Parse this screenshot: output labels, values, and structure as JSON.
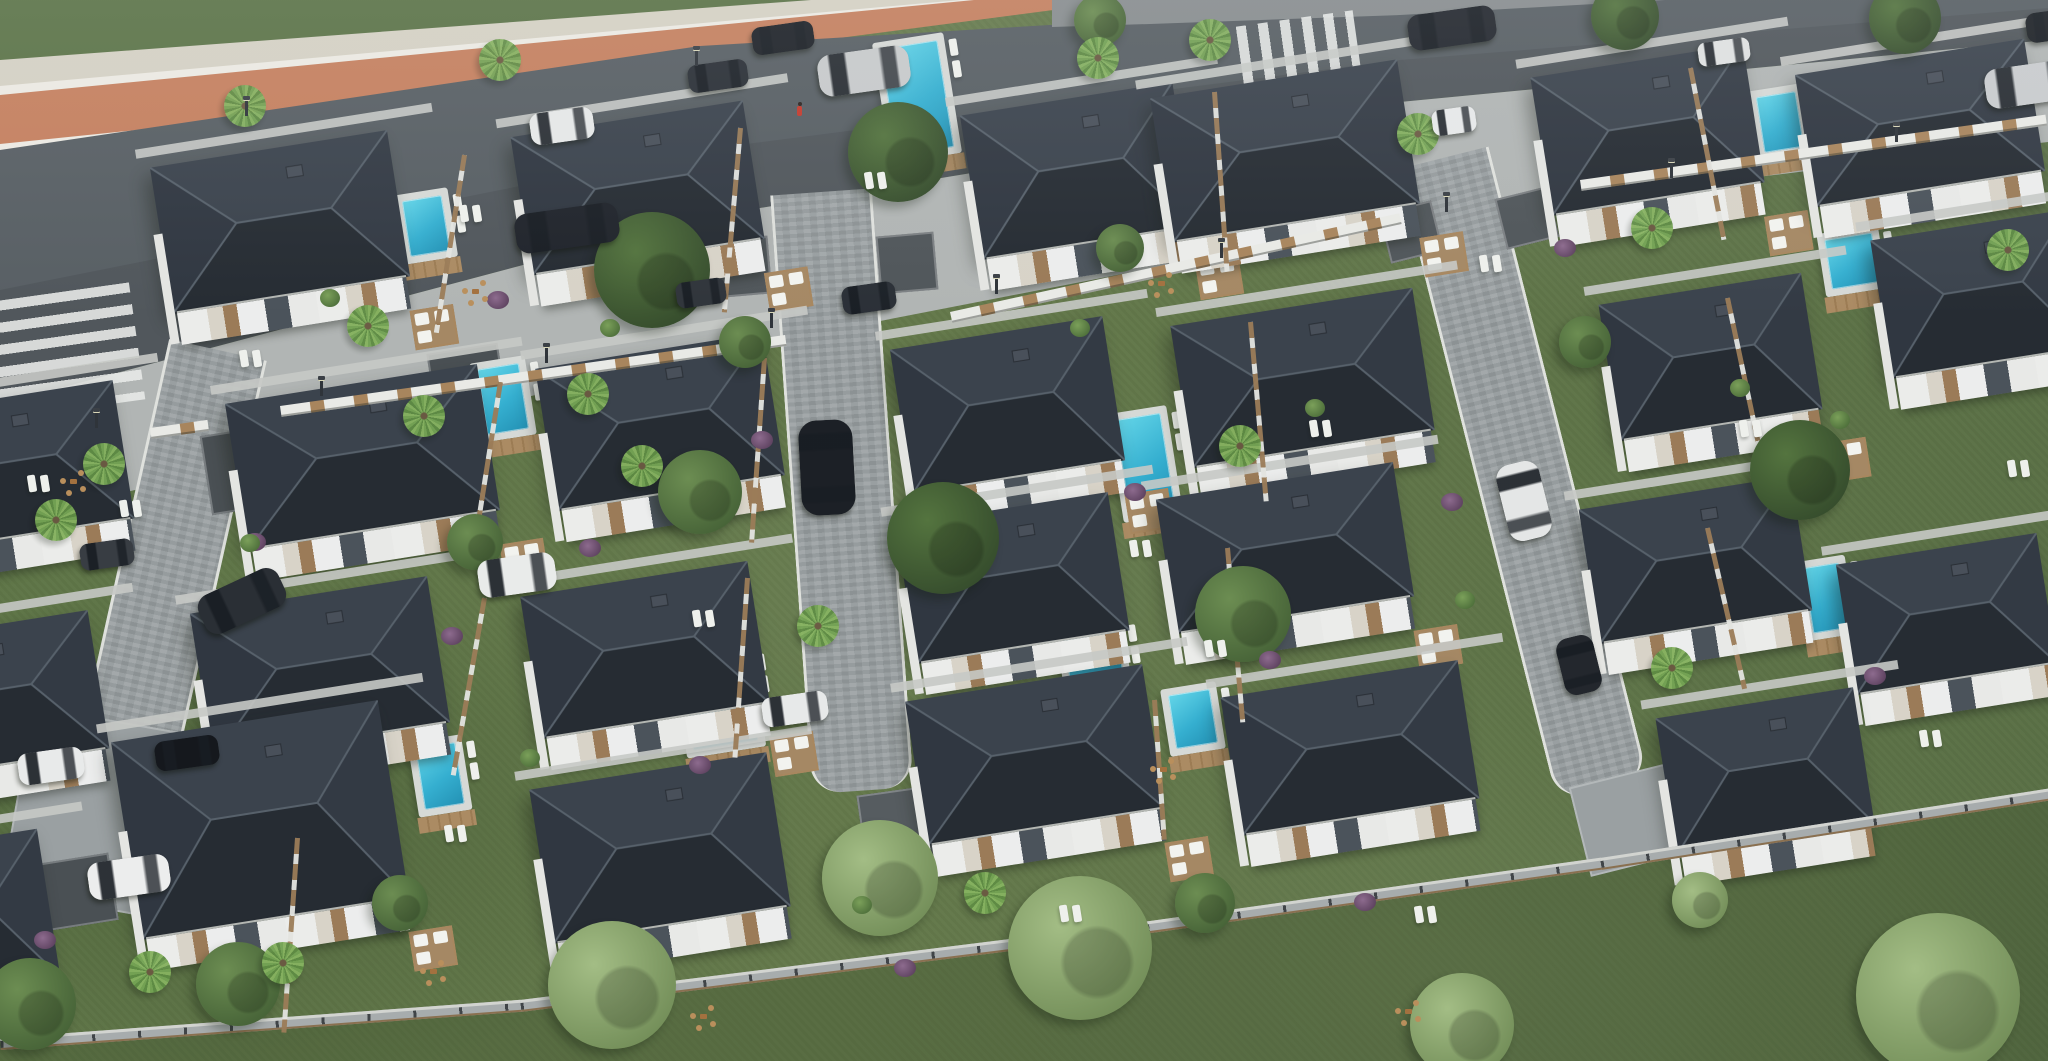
{
  "meta": {
    "width": 2048,
    "height": 1061,
    "description": "Aerial 3D render of a gated villa community: diagonal boulevard with coral bike lane at top, grid of dark hip-roofed white villas with private pools, cobblestone internal streets, lawns, palms and boundary fences",
    "text_content": "none"
  },
  "palette": {
    "lawn": "#60764a",
    "lawn_outer": "#576e44",
    "grass_top": "#5b7347",
    "asphalt": "#585f64",
    "bike_lane": "#c5805f",
    "sidewalk_pale": "#d5d1c4",
    "sidewalk_cobble": "#b1b5b4",
    "street_cobble": "#9aa0a2",
    "curb_white": "#dfe1dd",
    "roof_dark": "#262c33",
    "roof_light_face": "#3b434d",
    "roof_ridge": "#57616b",
    "facade_white": "#ebecea",
    "facade_cream": "#d8d3c8",
    "facade_wood": "#9b7b58",
    "facade_dark": "#4b535b",
    "pool_water": "#35afd0",
    "pool_deck_wood": "#ab8b63",
    "pad_dark": "#4a5054",
    "fence_wood": "#a8855d",
    "fence_white": "#e9eae6",
    "wall_gray": "#888d8f",
    "tree_dark": "#3d5733",
    "tree_mid": "#4f7040",
    "tree_pale": "#84a468",
    "palm_green": "#74a354",
    "car_black": "#1d2126",
    "car_white": "#e8eaea",
    "car_silver": "#c7cacb",
    "pedestrian_red": "#c43b2e"
  },
  "scene": {
    "bands": [
      {
        "name": "grass-top",
        "color": "#5b7347",
        "pts": [
          [
            0,
            0
          ],
          [
            880,
            0
          ],
          [
            0,
            62
          ]
        ]
      },
      {
        "name": "sidewalk-upper",
        "color": "#d5d1c4",
        "pts": [
          [
            0,
            60
          ],
          [
            865,
            -4
          ],
          [
            1020,
            -4
          ],
          [
            0,
            94
          ]
        ]
      },
      {
        "name": "bike-line-a",
        "color": "#eceae3",
        "pts": [
          [
            0,
            86
          ],
          [
            1005,
            -4
          ],
          [
            1018,
            -4
          ],
          [
            0,
            97
          ]
        ]
      },
      {
        "name": "bike-lane",
        "color": "#c5805f",
        "pts": [
          [
            0,
            95
          ],
          [
            1015,
            -4
          ],
          [
            1160,
            -4
          ],
          [
            0,
            148
          ]
        ]
      },
      {
        "name": "bike-line-b",
        "color": "#eceae3",
        "pts": [
          [
            0,
            144
          ],
          [
            1430,
            -2
          ],
          [
            1445,
            -2
          ],
          [
            0,
            157
          ]
        ]
      },
      {
        "name": "road",
        "color": "#585f64",
        "pts": [
          [
            0,
            150
          ],
          [
            700,
            46
          ],
          [
            1400,
            4
          ],
          [
            1740,
            -20
          ],
          [
            2048,
            -20
          ],
          [
            2048,
            40
          ],
          [
            1400,
            102
          ],
          [
            700,
            218
          ],
          [
            0,
            404
          ]
        ]
      },
      {
        "name": "road-shade",
        "color": "rgba(30,35,38,0.12)",
        "pts": [
          [
            0,
            290
          ],
          [
            700,
            150
          ],
          [
            1400,
            60
          ],
          [
            2048,
            8
          ],
          [
            2048,
            40
          ],
          [
            1400,
            102
          ],
          [
            700,
            218
          ],
          [
            0,
            404
          ]
        ]
      },
      {
        "name": "sidewalk-lower",
        "color": "#b1b5b4",
        "pts": [
          [
            0,
            404
          ],
          [
            700,
            218
          ],
          [
            1400,
            102
          ],
          [
            2048,
            40
          ],
          [
            2048,
            142
          ],
          [
            1400,
            220
          ],
          [
            700,
            356
          ],
          [
            0,
            522
          ]
        ]
      },
      {
        "name": "boundary-wall-top",
        "color": "#888d8f",
        "pts": [
          [
            1052,
            0
          ],
          [
            1665,
            0
          ],
          [
            1400,
            15
          ],
          [
            1150,
            24
          ],
          [
            1052,
            27
          ]
        ]
      },
      {
        "name": "outer-lawn",
        "color": "rgba(56,74,42,0.28)",
        "pts": [
          [
            0,
            1040
          ],
          [
            520,
            1002
          ],
          [
            1100,
            930
          ],
          [
            1600,
            860
          ],
          [
            2048,
            790
          ],
          [
            2048,
            1061
          ],
          [
            0,
            1061
          ]
        ]
      }
    ],
    "crosswalks": [
      {
        "x": -52,
        "y": 295,
        "w": 190,
        "h": 118,
        "rot": -8,
        "dir": 180
      },
      {
        "x": 1242,
        "y": 18,
        "w": 118,
        "h": 98,
        "rot": -8,
        "dir": 90
      }
    ],
    "streets": [
      {
        "name": "street-left",
        "cx": 215,
        "y": 350,
        "w": 94,
        "h": 556,
        "rot": 12.6
      },
      {
        "name": "street-center",
        "cx": 818,
        "y": 192,
        "w": 96,
        "h": 600,
        "rot": -4.0,
        "round": true
      },
      {
        "name": "street-right",
        "cx": 1440,
        "y": 158,
        "w": 88,
        "h": 652,
        "rot": -14.2,
        "round": true
      }
    ],
    "pads": [
      [
        15,
        722,
        200,
        188,
        10,
        "#9aa0a2"
      ],
      [
        40,
        858,
        74,
        68,
        -9,
        "#4a5054"
      ],
      [
        205,
        424,
        150,
        80,
        -9,
        "#4a5054"
      ],
      [
        862,
        790,
        76,
        86,
        -8,
        "#565c60"
      ],
      [
        1578,
        772,
        118,
        92,
        -14,
        "#9aa0a2"
      ],
      [
        712,
        238,
        58,
        58,
        -5,
        "#50565a"
      ],
      [
        878,
        234,
        58,
        58,
        -5,
        "#50565a"
      ],
      [
        1384,
        206,
        54,
        52,
        -14,
        "#50565a"
      ],
      [
        1500,
        192,
        54,
        52,
        -14,
        "#50565a"
      ],
      [
        430,
        348,
        72,
        52,
        -9,
        "#4a5054"
      ]
    ],
    "villas": [
      [
        160,
        148,
        240,
        148,
        1
      ],
      [
        520,
        118,
        235,
        140,
        1
      ],
      [
        970,
        98,
        215,
        146,
        1
      ],
      [
        1160,
        78,
        250,
        146,
        1
      ],
      [
        1540,
        60,
        215,
        140,
        1
      ],
      [
        1804,
        56,
        232,
        134,
        0
      ],
      [
        -115,
        398,
        240,
        140,
        0
      ],
      [
        235,
        383,
        255,
        148,
        1
      ],
      [
        545,
        350,
        230,
        144,
        0
      ],
      [
        900,
        332,
        215,
        146,
        1
      ],
      [
        1180,
        306,
        245,
        144,
        0
      ],
      [
        1608,
        288,
        205,
        138,
        1
      ],
      [
        1880,
        224,
        200,
        140,
        0
      ],
      [
        -140,
        628,
        240,
        140,
        0
      ],
      [
        200,
        594,
        240,
        148,
        0
      ],
      [
        530,
        578,
        230,
        144,
        1
      ],
      [
        905,
        508,
        215,
        140,
        0
      ],
      [
        1165,
        480,
        240,
        136,
        1
      ],
      [
        1588,
        492,
        215,
        136,
        0
      ],
      [
        1845,
        548,
        203,
        132,
        0
      ],
      [
        -170,
        845,
        220,
        150,
        0
      ],
      [
        125,
        720,
        270,
        200,
        1
      ],
      [
        540,
        770,
        240,
        156,
        0
      ],
      [
        915,
        682,
        240,
        146,
        1
      ],
      [
        1230,
        678,
        240,
        140,
        0
      ],
      [
        1665,
        702,
        200,
        138,
        0
      ]
    ],
    "villa_rot": -9,
    "pools": [
      [
        888,
        44,
        58,
        108
      ],
      [
        406,
        198,
        40,
        56
      ],
      [
        482,
        366,
        42,
        66
      ],
      [
        1122,
        416,
        46,
        96
      ],
      [
        686,
        660,
        66,
        86
      ],
      [
        420,
        745,
        40,
        62
      ],
      [
        1066,
        630,
        54,
        48
      ],
      [
        1172,
        692,
        42,
        54
      ],
      [
        1760,
        94,
        40,
        56
      ],
      [
        1828,
        236,
        48,
        50
      ],
      [
        1808,
        565,
        36,
        66
      ]
    ],
    "fences_road": [
      [
        280,
        406,
        510,
        -8.0
      ],
      [
        950,
        312,
        460,
        -12.4
      ],
      [
        1580,
        180,
        470,
        -8.0
      ],
      [
        150,
        428,
        58,
        -8.0
      ]
    ],
    "fences_bottom": [
      [
        0,
        1038,
        522,
        -4.2
      ],
      [
        520,
        1000,
        585,
        -7.1
      ],
      [
        1100,
        928,
        506,
        -8.0
      ],
      [
        1600,
        858,
        455,
        -8.8
      ]
    ],
    "fences_garden": [
      [
        462,
        155,
        180,
        9
      ],
      [
        738,
        128,
        185,
        5
      ],
      [
        1212,
        92,
        180,
        -4
      ],
      [
        1688,
        68,
        175,
        -11
      ],
      [
        498,
        382,
        185,
        9
      ],
      [
        762,
        358,
        185,
        4
      ],
      [
        1248,
        322,
        180,
        -5
      ],
      [
        1725,
        298,
        175,
        -12
      ],
      [
        482,
        598,
        180,
        10
      ],
      [
        745,
        578,
        180,
        4
      ],
      [
        1225,
        548,
        175,
        -5
      ],
      [
        1705,
        528,
        165,
        -13
      ],
      [
        295,
        838,
        195,
        4
      ],
      [
        1152,
        700,
        140,
        -4
      ]
    ],
    "trees": [
      [
        652,
        270,
        58,
        "d"
      ],
      [
        898,
        152,
        50,
        "d"
      ],
      [
        943,
        538,
        56,
        "d"
      ],
      [
        700,
        492,
        42,
        "m"
      ],
      [
        1243,
        614,
        48,
        "m"
      ],
      [
        1800,
        470,
        50,
        "d"
      ],
      [
        612,
        985,
        64,
        "p"
      ],
      [
        880,
        878,
        58,
        "p"
      ],
      [
        1080,
        948,
        72,
        "p"
      ],
      [
        1462,
        1025,
        52,
        "p"
      ],
      [
        1938,
        995,
        82,
        "p"
      ],
      [
        238,
        984,
        42,
        "m"
      ],
      [
        30,
        1004,
        46,
        "m"
      ],
      [
        1625,
        16,
        34,
        "d"
      ],
      [
        1905,
        18,
        36,
        "d"
      ],
      [
        475,
        542,
        28,
        "m"
      ],
      [
        745,
        342,
        26,
        "m"
      ],
      [
        1120,
        248,
        24,
        "m"
      ],
      [
        1585,
        342,
        26,
        "m"
      ],
      [
        400,
        903,
        28,
        "m"
      ],
      [
        1205,
        903,
        30,
        "m"
      ],
      [
        1700,
        900,
        28,
        "p"
      ],
      [
        1100,
        20,
        26,
        "m"
      ]
    ],
    "palms": [
      [
        368,
        326
      ],
      [
        424,
        416
      ],
      [
        588,
        394
      ],
      [
        642,
        466
      ],
      [
        104,
        464
      ],
      [
        56,
        520
      ],
      [
        1098,
        58
      ],
      [
        1210,
        40
      ],
      [
        1418,
        134
      ],
      [
        1652,
        228
      ],
      [
        818,
        626
      ],
      [
        500,
        60
      ],
      [
        245,
        106
      ],
      [
        1240,
        446
      ],
      [
        2008,
        250
      ],
      [
        985,
        893
      ],
      [
        150,
        972
      ],
      [
        283,
        963
      ],
      [
        1672,
        668
      ]
    ],
    "shrubs": [
      [
        498,
        300
      ],
      [
        762,
        440
      ],
      [
        1135,
        492
      ],
      [
        1270,
        660
      ],
      [
        700,
        765
      ],
      [
        1452,
        502
      ],
      [
        1875,
        676
      ],
      [
        452,
        636
      ],
      [
        1565,
        248
      ],
      [
        905,
        968
      ],
      [
        1365,
        902
      ],
      [
        45,
        940
      ],
      [
        255,
        542
      ],
      [
        590,
        548
      ]
    ],
    "bushes": [
      [
        330,
        298
      ],
      [
        610,
        328
      ],
      [
        1080,
        328
      ],
      [
        1315,
        408
      ],
      [
        1740,
        388
      ],
      [
        250,
        543
      ],
      [
        530,
        758
      ],
      [
        1465,
        600
      ],
      [
        1840,
        420
      ],
      [
        862,
        905
      ]
    ],
    "cars": [
      [
        530,
        110,
        64,
        32,
        -8,
        "#e6e8e8"
      ],
      [
        688,
        62,
        60,
        28,
        -8,
        "#2a2f36"
      ],
      [
        752,
        24,
        62,
        28,
        -8,
        "#1e2228"
      ],
      [
        818,
        50,
        92,
        42,
        -8,
        "#c7cacb"
      ],
      [
        1408,
        10,
        88,
        36,
        -8,
        "#23272e"
      ],
      [
        1698,
        40,
        52,
        24,
        -8,
        "#dfe1e1"
      ],
      [
        515,
        208,
        104,
        40,
        -8,
        "#20242b"
      ],
      [
        800,
        420,
        54,
        95,
        -3,
        "#1c2026"
      ],
      [
        1502,
        462,
        44,
        78,
        -14,
        "#e4e6e6"
      ],
      [
        1560,
        636,
        38,
        58,
        -14,
        "#23272d"
      ],
      [
        676,
        280,
        50,
        26,
        -8,
        "#30353b"
      ],
      [
        842,
        284,
        54,
        28,
        -8,
        "#2b3037"
      ],
      [
        80,
        541,
        54,
        27,
        -8,
        "#383d43"
      ],
      [
        18,
        750,
        66,
        32,
        -8,
        "#e8eaea"
      ],
      [
        155,
        738,
        64,
        30,
        -8,
        "#15181d"
      ],
      [
        88,
        858,
        82,
        38,
        -8,
        "#eceded"
      ],
      [
        198,
        580,
        88,
        42,
        -25,
        "#2a2f35"
      ],
      [
        478,
        556,
        78,
        38,
        -8,
        "#e9ebea"
      ],
      [
        762,
        694,
        66,
        30,
        -8,
        "#e7e9e9"
      ],
      [
        1985,
        64,
        92,
        40,
        -8,
        "#c9ccce"
      ],
      [
        2026,
        10,
        60,
        30,
        -8,
        "#1d2126"
      ],
      [
        1432,
        108,
        44,
        26,
        -8,
        "#e7e9e9"
      ]
    ],
    "lamps_low": [
      [
        95,
        412
      ],
      [
        320,
        380
      ],
      [
        545,
        347
      ],
      [
        770,
        312
      ],
      [
        995,
        278
      ],
      [
        1220,
        242
      ],
      [
        1445,
        196
      ],
      [
        1670,
        162
      ],
      [
        1895,
        126
      ]
    ],
    "lamps_high": [
      [
        245,
        100
      ],
      [
        695,
        50
      ]
    ],
    "loungers": [
      [
        460,
        205
      ],
      [
        865,
        172
      ],
      [
        1130,
        540
      ],
      [
        693,
        610
      ],
      [
        445,
        825
      ],
      [
        1205,
        640
      ],
      [
        1480,
        255
      ],
      [
        1740,
        420
      ],
      [
        1310,
        420
      ],
      [
        120,
        500
      ],
      [
        1920,
        730
      ],
      [
        1060,
        905
      ],
      [
        1415,
        906
      ],
      [
        2008,
        460
      ],
      [
        240,
        350
      ],
      [
        28,
        475
      ]
    ],
    "chairsets": [
      [
        462,
        280
      ],
      [
        1148,
        272
      ],
      [
        420,
        960
      ],
      [
        1150,
        758
      ],
      [
        1395,
        1000
      ],
      [
        690,
        1005
      ],
      [
        60,
        470
      ]
    ],
    "pedestrian": {
      "x": 797,
      "y": 106
    }
  }
}
